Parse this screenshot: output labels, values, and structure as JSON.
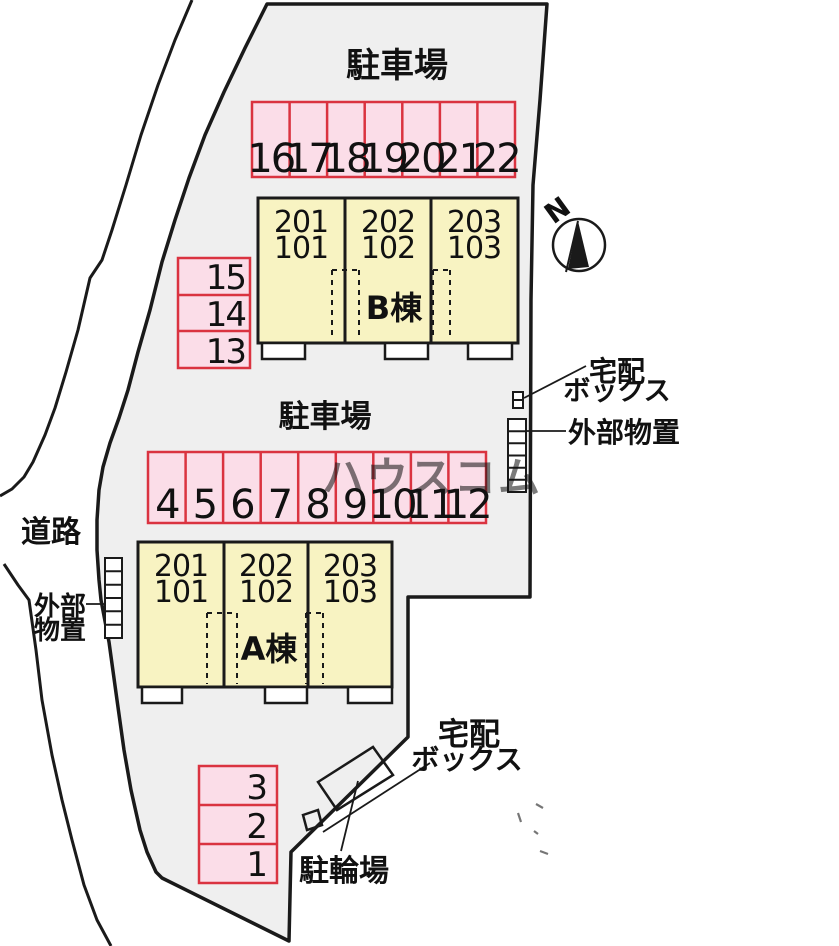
{
  "labels": {
    "parking_top": "駐車場",
    "parking_mid": "駐車場",
    "road": "道路",
    "bicycle_parking": "駐輪場",
    "delivery_box_right_line1": "宅配",
    "delivery_box_right_line2": "ボックス",
    "delivery_box_bottom_line1": "宅配",
    "delivery_box_bottom_line2": "ボックス",
    "storage_right": "外部物置",
    "storage_left_line1": "外部",
    "storage_left_line2": "物置",
    "compass_north": "N",
    "watermark": "ハウスコム"
  },
  "buildings": {
    "b": {
      "name": "B棟",
      "units": [
        {
          "upper": "201",
          "lower": "101"
        },
        {
          "upper": "202",
          "lower": "102"
        },
        {
          "upper": "203",
          "lower": "103"
        }
      ]
    },
    "a": {
      "name": "A棟",
      "units": [
        {
          "upper": "201",
          "lower": "101"
        },
        {
          "upper": "202",
          "lower": "102"
        },
        {
          "upper": "203",
          "lower": "103"
        }
      ]
    }
  },
  "parking": {
    "top_row": [
      "16",
      "17",
      "18",
      "19",
      "20",
      "21",
      "22"
    ],
    "mid_row": [
      "4",
      "5",
      "6",
      "7",
      "8",
      "9",
      "10",
      "11",
      "12"
    ],
    "left_column": [
      "15",
      "14",
      "13"
    ],
    "bottom_column": [
      "3",
      "2",
      "1"
    ]
  },
  "colors": {
    "site_fill": "#efefef",
    "stall_fill": "#fbdde8",
    "stall_border": "#da3340",
    "building_fill": "#f8f3c2",
    "line": "#1a1a1a",
    "text": "#111111",
    "watermark": "#c4c4c4",
    "white": "#ffffff"
  }
}
